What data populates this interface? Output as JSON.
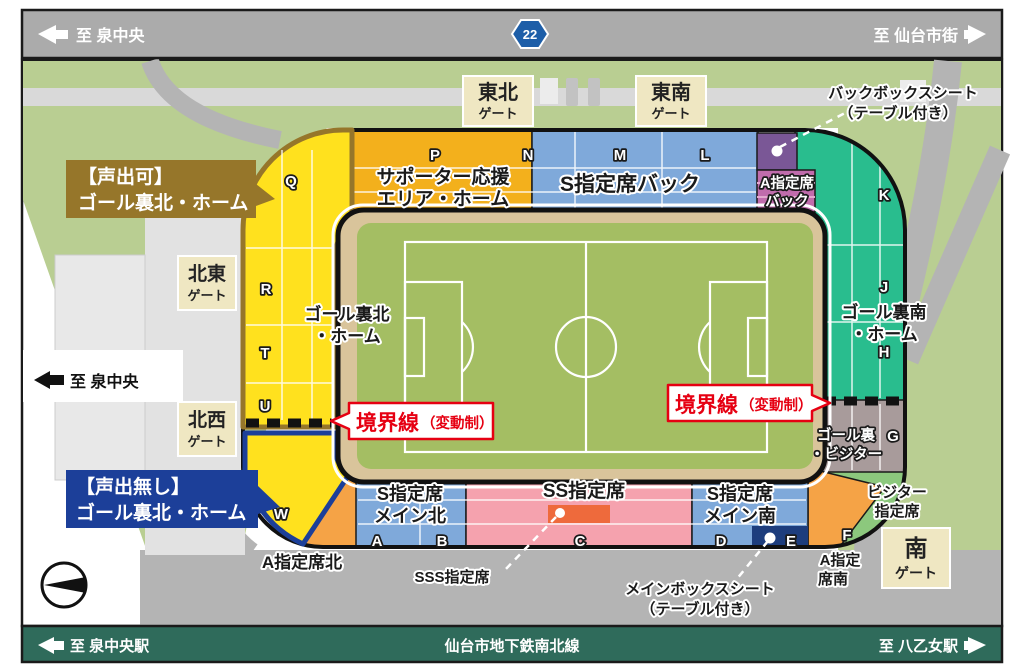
{
  "palette": {
    "road_bar": "#ABABAB",
    "rail_bar": "#2F6B5B",
    "boundary_red": "#E60012"
  },
  "top_road": {
    "left_label": "至 泉中央",
    "right_label": "至 仙台市街",
    "route_badge": "22"
  },
  "west_label": "至 泉中央",
  "bottom_rail": {
    "left_label": "至 泉中央駅",
    "center_label": "仙台市地下鉄南北線",
    "right_label": "至 八乙女駅"
  },
  "gates": {
    "tohoku": {
      "name": "東北",
      "suffix": "ゲート"
    },
    "tonan": {
      "name": "東南",
      "suffix": "ゲート"
    },
    "hokuto": {
      "name": "北東",
      "suffix": "ゲート"
    },
    "hokusei": {
      "name": "北西",
      "suffix": "ゲート"
    },
    "minami": {
      "name": "南",
      "suffix": "ゲート"
    }
  },
  "bubbles": {
    "voice_ok": {
      "line1": "【声出可】",
      "line2": "ゴール裏北・ホーム",
      "color": "#96762A"
    },
    "voice_none": {
      "line1": "【声出無し】",
      "line2": "ゴール裏北・ホーム",
      "color": "#1C3F99"
    }
  },
  "boundary": {
    "label": "境界線",
    "sub": "（変動制）"
  },
  "sections": {
    "goal_north": {
      "label1": "ゴール裏北",
      "label2": "・ホーム",
      "color": "#FFE11E",
      "blocks": [
        "Q",
        "R",
        "T",
        "U"
      ]
    },
    "goal_north_novoice": {
      "color": "#FFE11E",
      "blocks": [
        "W"
      ]
    },
    "supporter": {
      "label1": "サポーター応援",
      "label2": "エリア・ホーム",
      "color": "#F3B01C",
      "blocks": [
        "P"
      ]
    },
    "s_back": {
      "label": "S指定席バック",
      "color": "#7FA9DA",
      "blocks": [
        "N",
        "M",
        "L"
      ]
    },
    "back_box": {
      "callout1": "バックボックスシート",
      "callout2": "（テーブル付き）",
      "color": "#7A5796"
    },
    "a_back": {
      "label1": "A指定席",
      "label2": "バック",
      "color": "#C06CAC"
    },
    "goal_south": {
      "label1": "ゴール裏南",
      "label2": "・ホーム",
      "color": "#29BD8E",
      "blocks": [
        "K",
        "J",
        "H"
      ]
    },
    "goal_visitor": {
      "label1": "ゴール裏",
      "label2": "・ビジター",
      "color": "#A89B9B",
      "blocks": [
        "G"
      ]
    },
    "visitor": {
      "label1": "ビジター",
      "label2": "指定席",
      "color": "#8CC87D"
    },
    "a_south": {
      "label1": "A指定",
      "label2": "席南",
      "color": "#F5A346",
      "blocks": [
        "F"
      ]
    },
    "s_main_south": {
      "label1": "S指定席",
      "label2": "メイン南",
      "color": "#7FA9DA",
      "blocks": [
        "D",
        "E"
      ]
    },
    "ss": {
      "label": "SS指定席",
      "color": "#F5A2AE",
      "blocks": [
        "C"
      ]
    },
    "sss": {
      "label": "SSS指定席",
      "color": "#EE6A3C"
    },
    "main_box": {
      "callout1": "メインボックスシート",
      "callout2": "（テーブル付き）",
      "color": "#1D3D7D"
    },
    "s_main_north": {
      "label1": "S指定席",
      "label2": "メイン北",
      "color": "#7FA9DA",
      "blocks": [
        "A",
        "B"
      ]
    },
    "a_north": {
      "label": "A指定席北",
      "color": "#F5A346"
    }
  }
}
